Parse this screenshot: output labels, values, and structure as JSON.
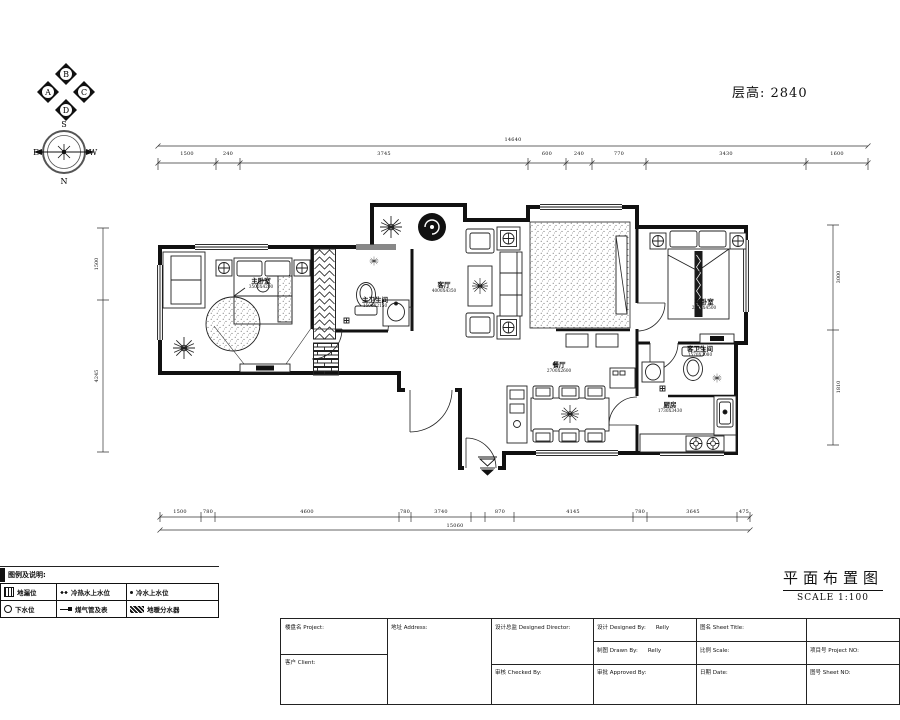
{
  "meta": {
    "floor_height_label": "层高: 2840"
  },
  "compass": {
    "n": "N",
    "s": "S",
    "e": "E",
    "w": "W"
  },
  "elevation_marker": {
    "top": "B",
    "left": "A",
    "right": "C",
    "bottom": "D"
  },
  "rooms": {
    "master_bedroom": {
      "name": "主卧室",
      "size": "3500X4200"
    },
    "master_bath": {
      "name": "主卫生间",
      "size": "1500X2150"
    },
    "living_room": {
      "name": "客厅",
      "size": "4000X4350"
    },
    "dining_room": {
      "name": "餐厅",
      "size": "2700X2600"
    },
    "kitchen": {
      "name": "厨房",
      "size": "1730X3430"
    },
    "guest_bath": {
      "name": "客卫生间",
      "size": "1570X2080"
    },
    "guest_bedroom": {
      "name": "客卧室",
      "size": "2745X4500"
    }
  },
  "dimensions": {
    "top": [
      "1500",
      "240",
      "3745",
      "600",
      "240",
      "770",
      "3430",
      "1600"
    ],
    "top_total": "14640",
    "bottom": [
      "1500",
      "780",
      "4600",
      "780",
      "3740",
      "870",
      "4145",
      "780",
      "3645",
      "475"
    ],
    "bottom_total": "15060",
    "left": [
      "1500",
      "4245"
    ],
    "right": [
      "3000",
      "1810"
    ]
  },
  "legend": {
    "title": "图例及说明:",
    "items": [
      {
        "icon": "floor-drain-icon",
        "label": "地漏位"
      },
      {
        "icon": "hot-cold-water-icon",
        "label": "冷热水上水位"
      },
      {
        "icon": "cold-water-icon",
        "label": "冷水上水位"
      },
      {
        "icon": "drain-outlet-icon",
        "label": "下水位"
      },
      {
        "icon": "gas-pipe-meter-icon",
        "label": "煤气管及表"
      },
      {
        "icon": "floor-heating-manifold-icon",
        "label": "地暖分水器"
      }
    ]
  },
  "sheet": {
    "title": "平面布置图",
    "scale": "SCALE 1:100"
  },
  "titleblock": {
    "project_label": "楼盘名 Project:",
    "client_label": "客户 Client:",
    "address_label": "地址 Address:",
    "design_director_label": "设计总监 Designed Director:",
    "checked_label": "审核 Checked By:",
    "designed_label": "设计 Designed By:",
    "designed_value": "Relly",
    "drawn_label": "制图 Drawn By:",
    "drawn_value": "Relly",
    "approved_label": "审批 Approved By:",
    "sheet_title_label": "图名 Sheet Title:",
    "scale_label": "比例 Scale:",
    "date_label": "日期 Date:",
    "project_no_label": "项目号 Project NO:",
    "sheet_no_label": "图号 Sheet NO:"
  }
}
